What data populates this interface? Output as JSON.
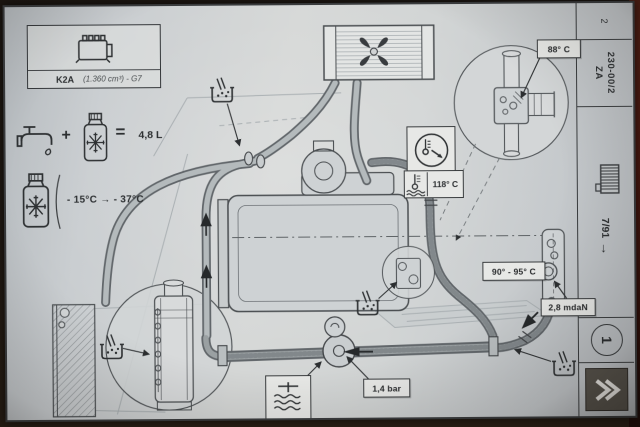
{
  "engine_box": {
    "code": "K2A",
    "spec": "(1.360 cm³) - G7"
  },
  "fill_info": {
    "plus": "+",
    "equals": "=",
    "capacity": "4,8 L"
  },
  "antifreeze_info": {
    "range": "- 15°C → - 37°C"
  },
  "callouts": {
    "thermostat_opening": "88° C",
    "warning_lamp": "118° C",
    "fan_cut_in": "90° - 95° C",
    "tightening_torque": "2,8 mdaN",
    "valve_pressure": "1,4 bar"
  },
  "sidebar": {
    "sheet_number": "2",
    "section_code": "ZA",
    "section_ref": "230-00/2",
    "edition_date": "7/91",
    "edition_arrow": "→",
    "page_number": "1"
  },
  "icons": {
    "engine": "engine-pictogram",
    "tap": "water-tap",
    "antifreeze_jug": "jug-with-snowflake",
    "fan": "four-blade-fan",
    "gauge": "temperature-gauge",
    "thermometer": "thermometer-over-coolant",
    "pressure_cap": "filler-cap-over-coolant",
    "bleed_point": "bleed-beaker",
    "radiator": "radiator-grille",
    "next_page": "double-chevron-right"
  },
  "colors": {
    "paper": "#cdd1d3",
    "ink": "#2c2f31",
    "photo_edge": "#1c1611",
    "spine_red": "#4e1810",
    "hose": "#8e9497"
  }
}
